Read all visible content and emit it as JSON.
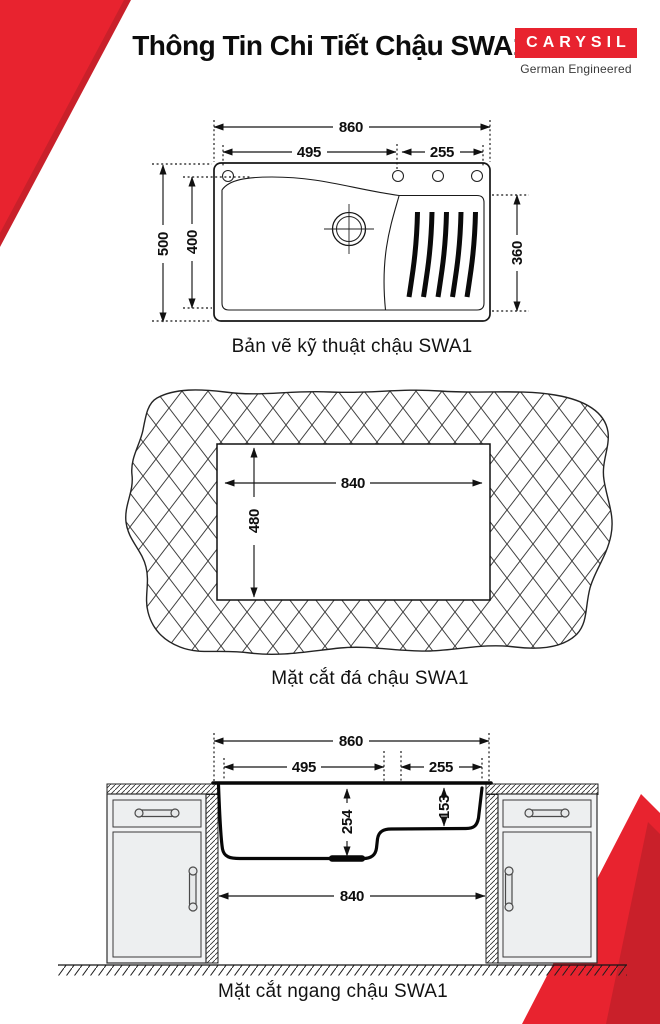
{
  "header": {
    "title": "Thông Tin Chi Tiết Chậu SWA1",
    "logo": {
      "brand": "CARYSIL",
      "tagline": "German Engineered"
    }
  },
  "colors": {
    "accent_red": "#e8232f",
    "accent_red_dark": "#c9202a",
    "line": "#1a1a1a"
  },
  "drawings": {
    "top_view": {
      "caption": "Bản vẽ kỹ thuật chậu SWA1",
      "dims": {
        "overall_width": "860",
        "bowl_width": "495",
        "drainboard_width": "255",
        "overall_depth": "500",
        "bowl_depth": "400",
        "drainboard_depth": "360"
      }
    },
    "stone_cutout": {
      "caption": "Mặt cắt đá chậu SWA1",
      "dims": {
        "cutout_width": "840",
        "cutout_depth": "480"
      }
    },
    "cross_section": {
      "caption": "Mặt cắt ngang chậu SWA1",
      "dims": {
        "overall_width": "860",
        "bowl_width": "495",
        "drainboard_width": "255",
        "bowl_depth": "254",
        "drainboard_depth": "153",
        "cutout_width": "840"
      }
    }
  }
}
